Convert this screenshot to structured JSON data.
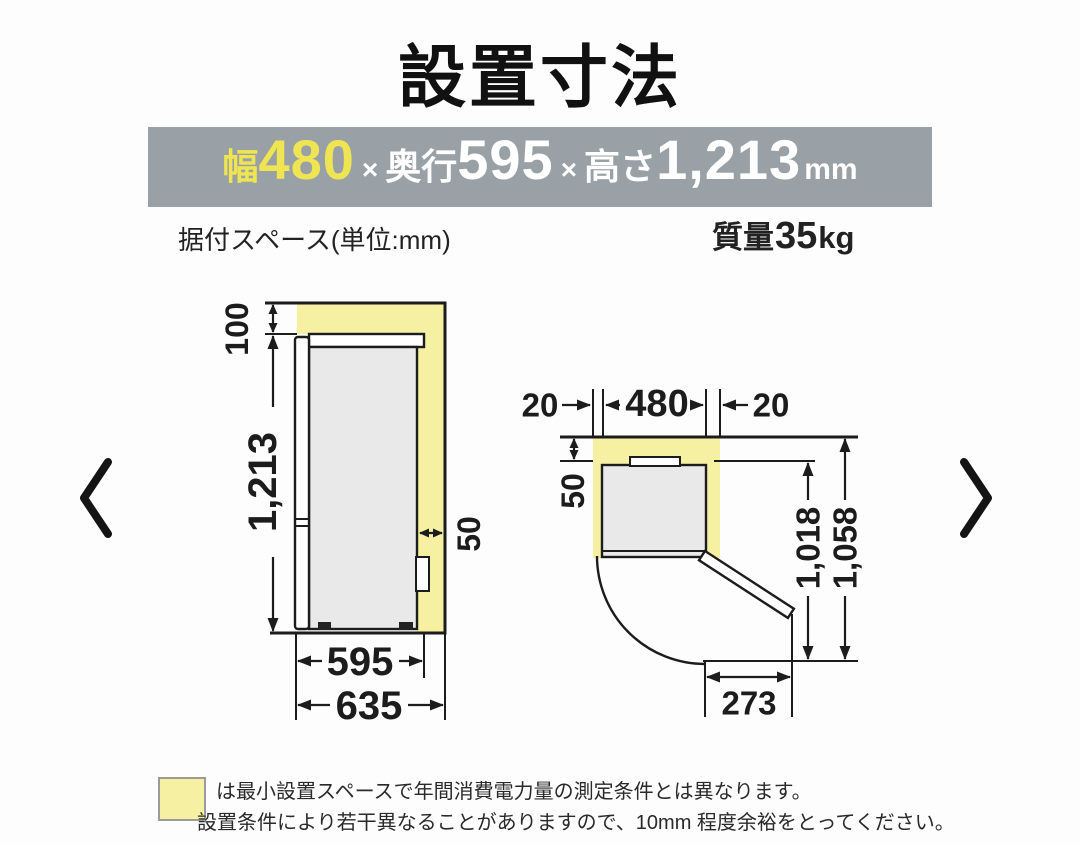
{
  "title": "設置寸法",
  "banner": {
    "width_label": "幅",
    "width_value": "480",
    "times": "×",
    "depth_label": "奥行",
    "depth_value": "595",
    "height_label": "高さ",
    "height_value": "1,213",
    "unit": "mm",
    "bg_color": "#9aa1a6",
    "highlight_color": "#efe552"
  },
  "subheader": {
    "install_space": "据付スペース(単位:mm)",
    "weight_label": "質量",
    "weight_value": "35",
    "weight_unit": "kg"
  },
  "side_view": {
    "top_clearance": "100",
    "height": "1,213",
    "rear_clearance": "50",
    "depth": "595",
    "total_depth": "635"
  },
  "top_view": {
    "left_clearance": "20",
    "width": "480",
    "right_clearance": "20",
    "rear_clearance": "50",
    "open_depth": "1,018",
    "total_open_depth": "1,058",
    "door_open_width": "273"
  },
  "legend": {
    "line1": "は最小設置スペースで年間消費電力量の測定条件とは異なります。",
    "line2": "設置条件により若干異なることがありますので、10mm 程度余裕をとってください。"
  },
  "nav": {
    "prev_icon": "chevron-left",
    "next_icon": "chevron-right"
  },
  "colors": {
    "space_highlight": "#f6f0a2",
    "product_fill": "#e9e9e9",
    "line": "#1c1c1c"
  }
}
